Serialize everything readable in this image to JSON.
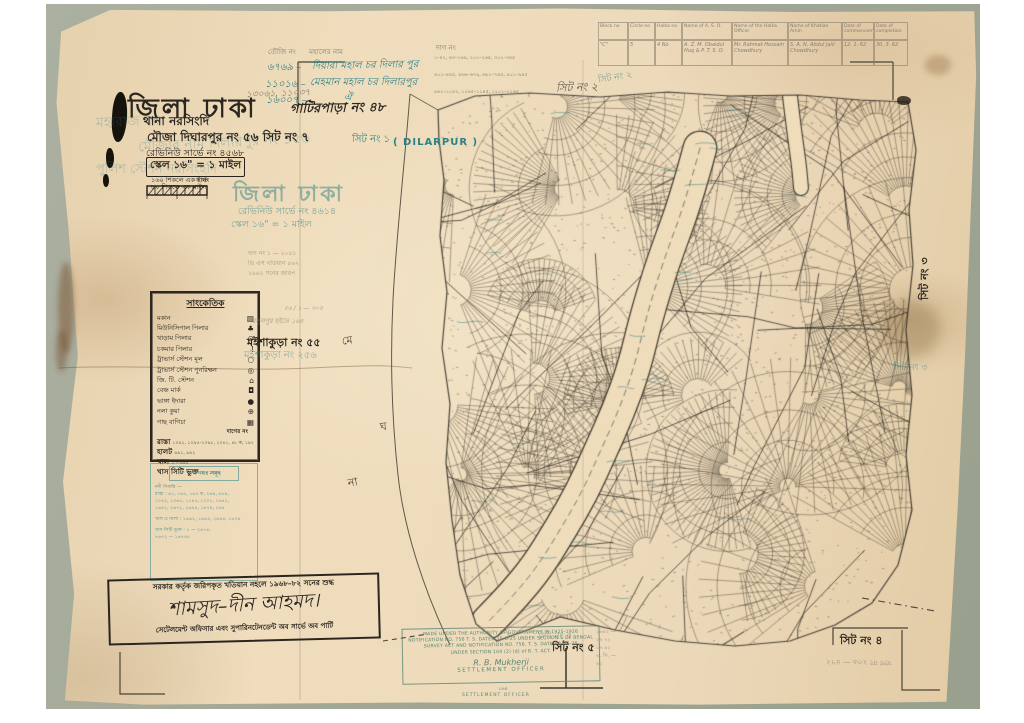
{
  "colors": {
    "paper": "#ecd9ba",
    "backdrop": "#a6ab9c",
    "ink": "#2b2620",
    "teal": "#2c8187",
    "pencil": "#857d6f",
    "green_stamp": "#5a8472"
  },
  "title_block": {
    "district": "জিলা ঢাকা",
    "gatirpara": "গাটিরপাড়া নং ৪৮",
    "pencil_numbers": "১৩০৬১, ১১০৩৭",
    "thana": "থানা নরসিংদি",
    "mouza": "মৌজা দিঘারপুর নং ৫৬ সিট নং ৭",
    "sheet_teal": "সিট নং ১",
    "dilarpur": "( DILARPUR )",
    "revenue": "রেভিনিউ সার্ভে নং ৪৫৬৮",
    "scale": "স্কেল ১৬\" = ১ মাইল",
    "sub1": "১৬০ শিকলে এক ইঞ্চি",
    "sub2": "৮০ শিকলে এক মাইল",
    "furlong": "ফার্লং",
    "ghost_title": "জিলা ঢাকা",
    "ghost_left1": "মহারাজ নর",
    "ghost_left2": "পুলিশ স্টেশন নরসিংহদি",
    "ghost_mouza": "মৌজার নাম দিলারপুর নং ১৫৬",
    "ghost_revenue": "রেভিনিউ সার্ভে নং ৪৬১৪",
    "ghost_scale": "স্কেল ১৬\" = ১ মাইল"
  },
  "touji_table": {
    "header": "তৌজি নং      মহালের নাম",
    "dag_header": "দাগ নং",
    "rows": [
      {
        "no": "৬৭৬৯ –",
        "name": "দিয়ারা মহাল চর দিলার পুর",
        "dags": "১–৪২, ৬৩–১৬৯, ২০১–২৬৫, ৩০১–৩৪৫"
      },
      {
        "no": "১১০১৬ –",
        "name": "মেহমান মহাল চর দিলারপুর",
        "dags": "৪০১–৪৪৫, ৪৬৬–৬৭৯, ৬৮১–৭৪৫, ৯০১–৯৪৫"
      },
      {
        "no": "১৬০০৭ –",
        "name": "ঐ",
        "dags": "৯৬১–১০৪২, ১০৬৫–১১৪৫, ১২০১–১২৬৫"
      }
    ]
  },
  "survey_table": {
    "headers": [
      "Block no",
      "Circle no",
      "Halka no",
      "Name of A. S. O.",
      "Name of the Halka Officer",
      "Name of Khatian Amin",
      "Date of commencement",
      "Date of completion"
    ],
    "row": [
      "\"C\"",
      "5",
      "4 No",
      "A. Z. M. Obaidul Huq & P. T. S. O.",
      "Mr. Rahmat Hossain Chowdhury",
      "S. A. N. Abdul Jalil Chowdhury",
      "12. 1. 62",
      "30. 3. 62"
    ]
  },
  "legend": {
    "title": "সাংকেতিক",
    "items": [
      {
        "label": "মকান",
        "sym": "▨"
      },
      {
        "label": "মিউনিসিপাল পিলার",
        "sym": "♣"
      },
      {
        "label": "খাড়াম পিলার",
        "sym": "⊙"
      },
      {
        "label": "চকমার পিলার",
        "sym": "!"
      },
      {
        "label": "ট্রাভার্স স্টেশন মূল",
        "sym": "○"
      },
      {
        "label": "ট্রাভার্স স্টেশন পুনরিক্ষন",
        "sym": "◎"
      },
      {
        "label": "জি. টি. স্টেশন",
        "sym": "⌂"
      },
      {
        "label": "বেঞ্চ মার্ক",
        "sym": "◘"
      },
      {
        "label": "ভাঙ্গা ইদারা",
        "sym": "●"
      },
      {
        "label": "নলা কুয়া",
        "sym": "⊕"
      },
      {
        "label": "গাছ বাগিচা",
        "sym": "▦"
      }
    ],
    "dag_header": "দাগের নং",
    "boundaries": [
      {
        "label": "রাস্তা",
        "nums": "১০৯২, ১০৯৫–১০৯৮, ২০৪১, ৪৮ ক, ১৯২"
      },
      {
        "label": "হালট",
        "nums": "৬৯১, ৬৯২"
      },
      {
        "label": "খাল",
        "nums": "১ – ৬৯৫"
      },
      {
        "label": "খাস সিটি ভুক্ত",
        "nums": "১ – ১০৪৭"
      }
    ]
  },
  "blue_block": {
    "header": "দাগ নম্বর সমূহ",
    "lines": [
      "নদী সিকস্তি —",
      "রাস্তা :  ৬১, ১৬২, ১৬৭ ক, ২৬৯, ৬৮৯,",
      "১০৪২, ১০৬৫, ১১৪৫, ১২০১, ১৬৪২,",
      "১৬৯২, ২৬৭২, ২৬৯৪, ১৬৭৯, ২৬৫",
      "খাল ও নালা :  ১৯৬২, ১৯৬৪, ২৬৯৪, ১৬৭৯",
      "খাস সিটি ভুক্ত :  ১ — ২৬৭৪,",
      "৭৬৭২ — ১৬৭৪৫"
    ]
  },
  "stamp": {
    "line1": "সরকার কর্তৃক জরিপকৃত খতিয়ান নহলে ১৯৬৮–৮২ সনের শুদ্ধ",
    "signature": "শামসুদ–দীন আহমদ।",
    "line2": "সেটেলমেন্ট অফিসার এবং সুপারিনটেনডেন্ট অব সার্ভে অব পার্টি"
  },
  "green_stamp": {
    "lines": [
      "MADE UNDER THE AUTHORITY OF GOVERNMENT IN 1925-1926",
      "NOTIFICATION NO. 756 T. S. DATED 15-6-25 UNDER SECTION 5 OF BENGAL",
      "SURVEY ACT AND NOTIFICATION NO. 756. T. S. DATED 15-6-25",
      "UNDER SECTION 104  (2)  (d)  of  B. T. ACT."
    ],
    "signature": "R. B. Mukherji",
    "title": "SETTLEMENT OFFICER",
    "below_number": "১৬৪",
    "below_title": "SETTLEMENT OFFICER"
  },
  "sheet_labels": {
    "sheet2_pencil": "সিট নং ২",
    "sheet2_teal": "সিট নং ২",
    "sheet3_ink": "সিট নং ৩",
    "sheet3_teal": "সিট নং ৩",
    "sheet4_ink": "সিট নং ৪",
    "sheet4_reverse": "দাগ নং ২৩৬ — ৪৭২",
    "sheet5_ink": "সিট নং ৫",
    "sheet5_teal": "সিট নং ৫"
  },
  "village_labels": {
    "moishakura_ink": "মইশাকুড়া নং ৫৫",
    "moishakura_teal": "মইশাকুড়া নং ২৫৬",
    "pencil_note1": "রসুলপুর হইতে ১৬৪",
    "pencil_note2": "৫৬ / ১ — ৩০৪"
  },
  "river_label": {
    "ch1": "মে",
    "ch2": "ঘ",
    "ch3": "না"
  },
  "misc": {
    "pencil_mid": [
      "দাগ নং ১ — ২০৪১",
      "ডি এস খতিয়ান ৪৬২",
      "১৯৬২ সনের জরিপ"
    ],
    "bottom_pencil": [
      "১৬৪২ —",
      "২৬ ৭২",
      "১৬ ৯২",
      "এ. সি. —",
      "৪২"
    ]
  }
}
